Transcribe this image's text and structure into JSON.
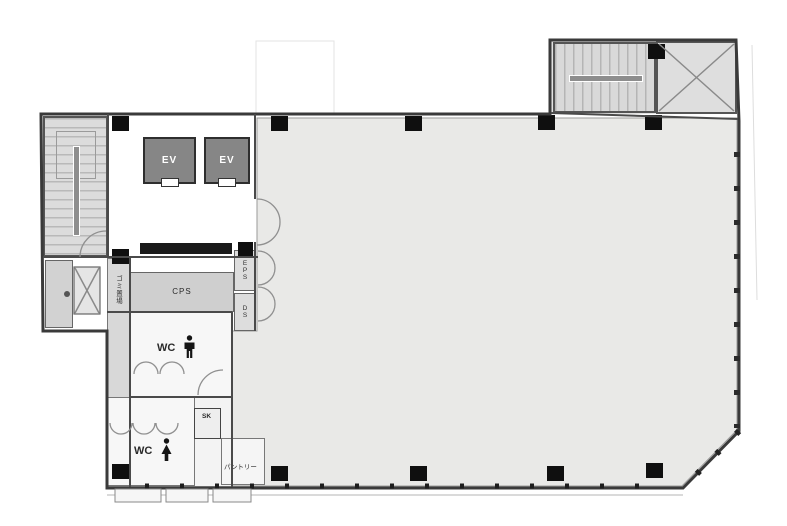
{
  "floor_plan": {
    "labels": {
      "elevator_1": "EV",
      "elevator_2": "EV",
      "cps": "CPS",
      "eps": "EPS",
      "ds": "DS",
      "wc_men": "WC",
      "wc_women": "WC",
      "sk": "SK",
      "pantry": "パントリー",
      "garbage_storage": "ゴミ置場"
    },
    "icons": {
      "male_figure": "male-figure-icon",
      "female_figure": "female-figure-icon",
      "stair_top_left": "staircase-icon",
      "stair_top_right": "staircase-icon",
      "cross_brace_shaft": "x-brace-icon"
    },
    "colors": {
      "background": "#ffffff",
      "office_area_fill": "#e9e9e7",
      "upper_block_fill": "#e2e2e2",
      "service_room_fill": "#d2d2d2",
      "elevator_cab_fill": "#868686",
      "wall_stroke": "#3a3a3a",
      "column_fill": "#0f0f0f"
    }
  }
}
